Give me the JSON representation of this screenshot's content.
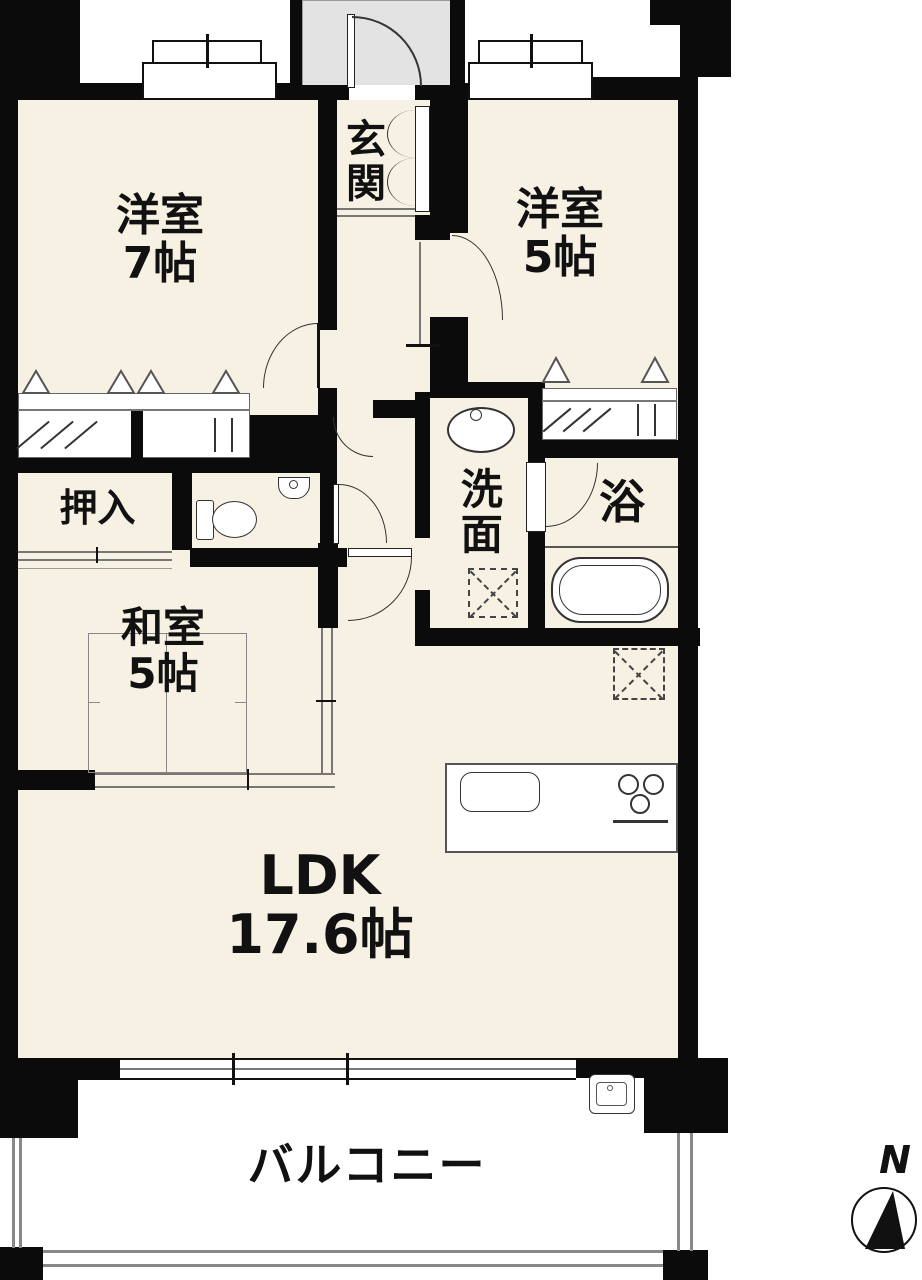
{
  "rooms": {
    "w7": {
      "name": "洋室",
      "size": "7帖"
    },
    "w5": {
      "name": "洋室",
      "size": "5帖"
    },
    "genkan": {
      "label": "玄関"
    },
    "oshiire": {
      "label": "押入"
    },
    "washitsu": {
      "name": "和室",
      "size": "5帖"
    },
    "senmen": {
      "label": "洗面"
    },
    "bath": {
      "label": "浴"
    },
    "ldk": {
      "name": "LDK",
      "size": "17.6帖"
    },
    "balcony": {
      "label": "バルコニー"
    }
  },
  "compass": {
    "north_label": "N"
  },
  "colors": {
    "wall": "#0b0b0b",
    "room_fill": "#f7f1e3",
    "porch_fill": "#e3e3e3",
    "thin_line": "#666666"
  },
  "icons": [
    "toilet",
    "hand-basin",
    "vanity-sink",
    "bathtub",
    "washing-machine-space",
    "refrigerator-space",
    "kitchen-sink",
    "stove-burners",
    "balcony-sink",
    "closet-door-mark",
    "entrance-door-arc",
    "room-door-arc",
    "north-compass"
  ]
}
